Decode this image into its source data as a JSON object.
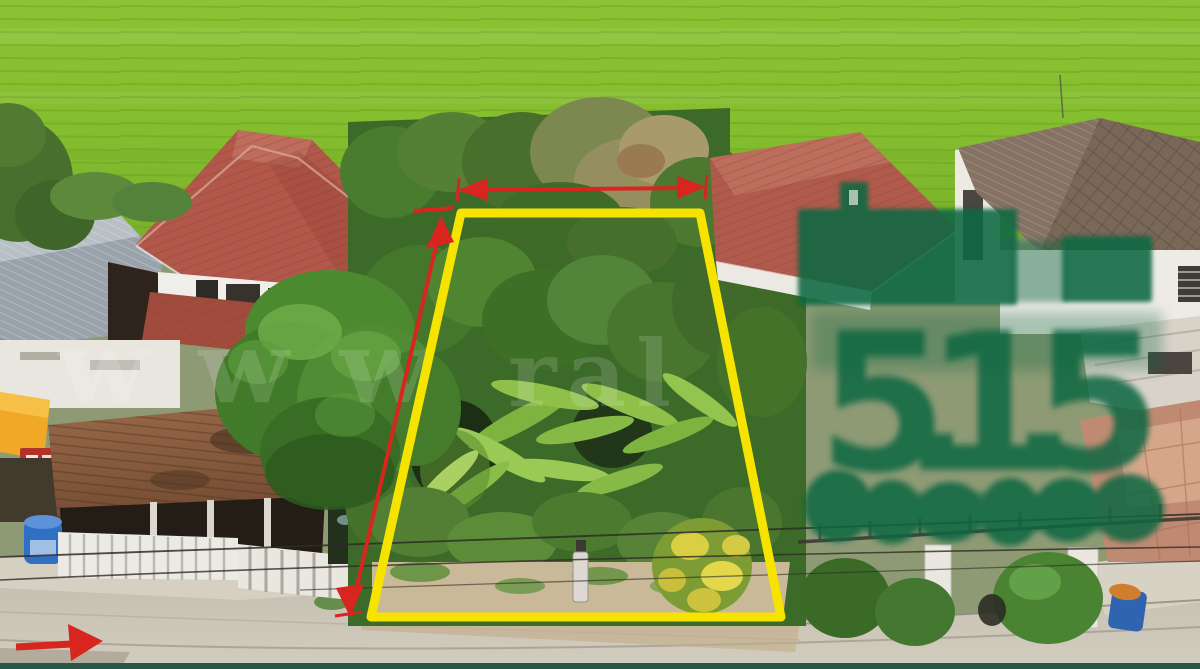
{
  "image": {
    "description": "Aerial drone photo of a vacant land plot for sale, outlined in yellow, between residential houses with a rice field behind and a concrete road in front",
    "width_px": 1200,
    "height_px": 669
  },
  "watermark": {
    "fragment_left": "www",
    "fragment_center": "ral",
    "color": "#ffffff"
  },
  "price_overlay": {
    "digits": "5.1.5",
    "color": "#0a6742",
    "top_block": "redacted green bar",
    "bottom_block": "redacted green script"
  },
  "annotations": {
    "plot_outline_color": "#f6e400",
    "arrow_color": "#d8251f",
    "width_arrow": "horizontal double-headed arrow",
    "depth_arrow": "vertical double-headed arrow",
    "road_arrow": "right-pointing arrow"
  },
  "palette": {
    "rice_field": "#85bf31",
    "road": "#c9c3b5",
    "left_house_roof": "#b2584a",
    "right_house_roof_a": "#b05a4c",
    "right_house_roof_b": "#7d6a5a",
    "gray_roof": "#9aa3ab",
    "brown_awning": "#8a5c3e",
    "yellow_awning": "#f0a826",
    "tree_green": "#4c8a2f",
    "plot_green": "#3c6a28",
    "water_tank_blue": "#2f6fc4",
    "barrel_blue": "#2e64b0",
    "footer_strip": "#2a564a"
  }
}
